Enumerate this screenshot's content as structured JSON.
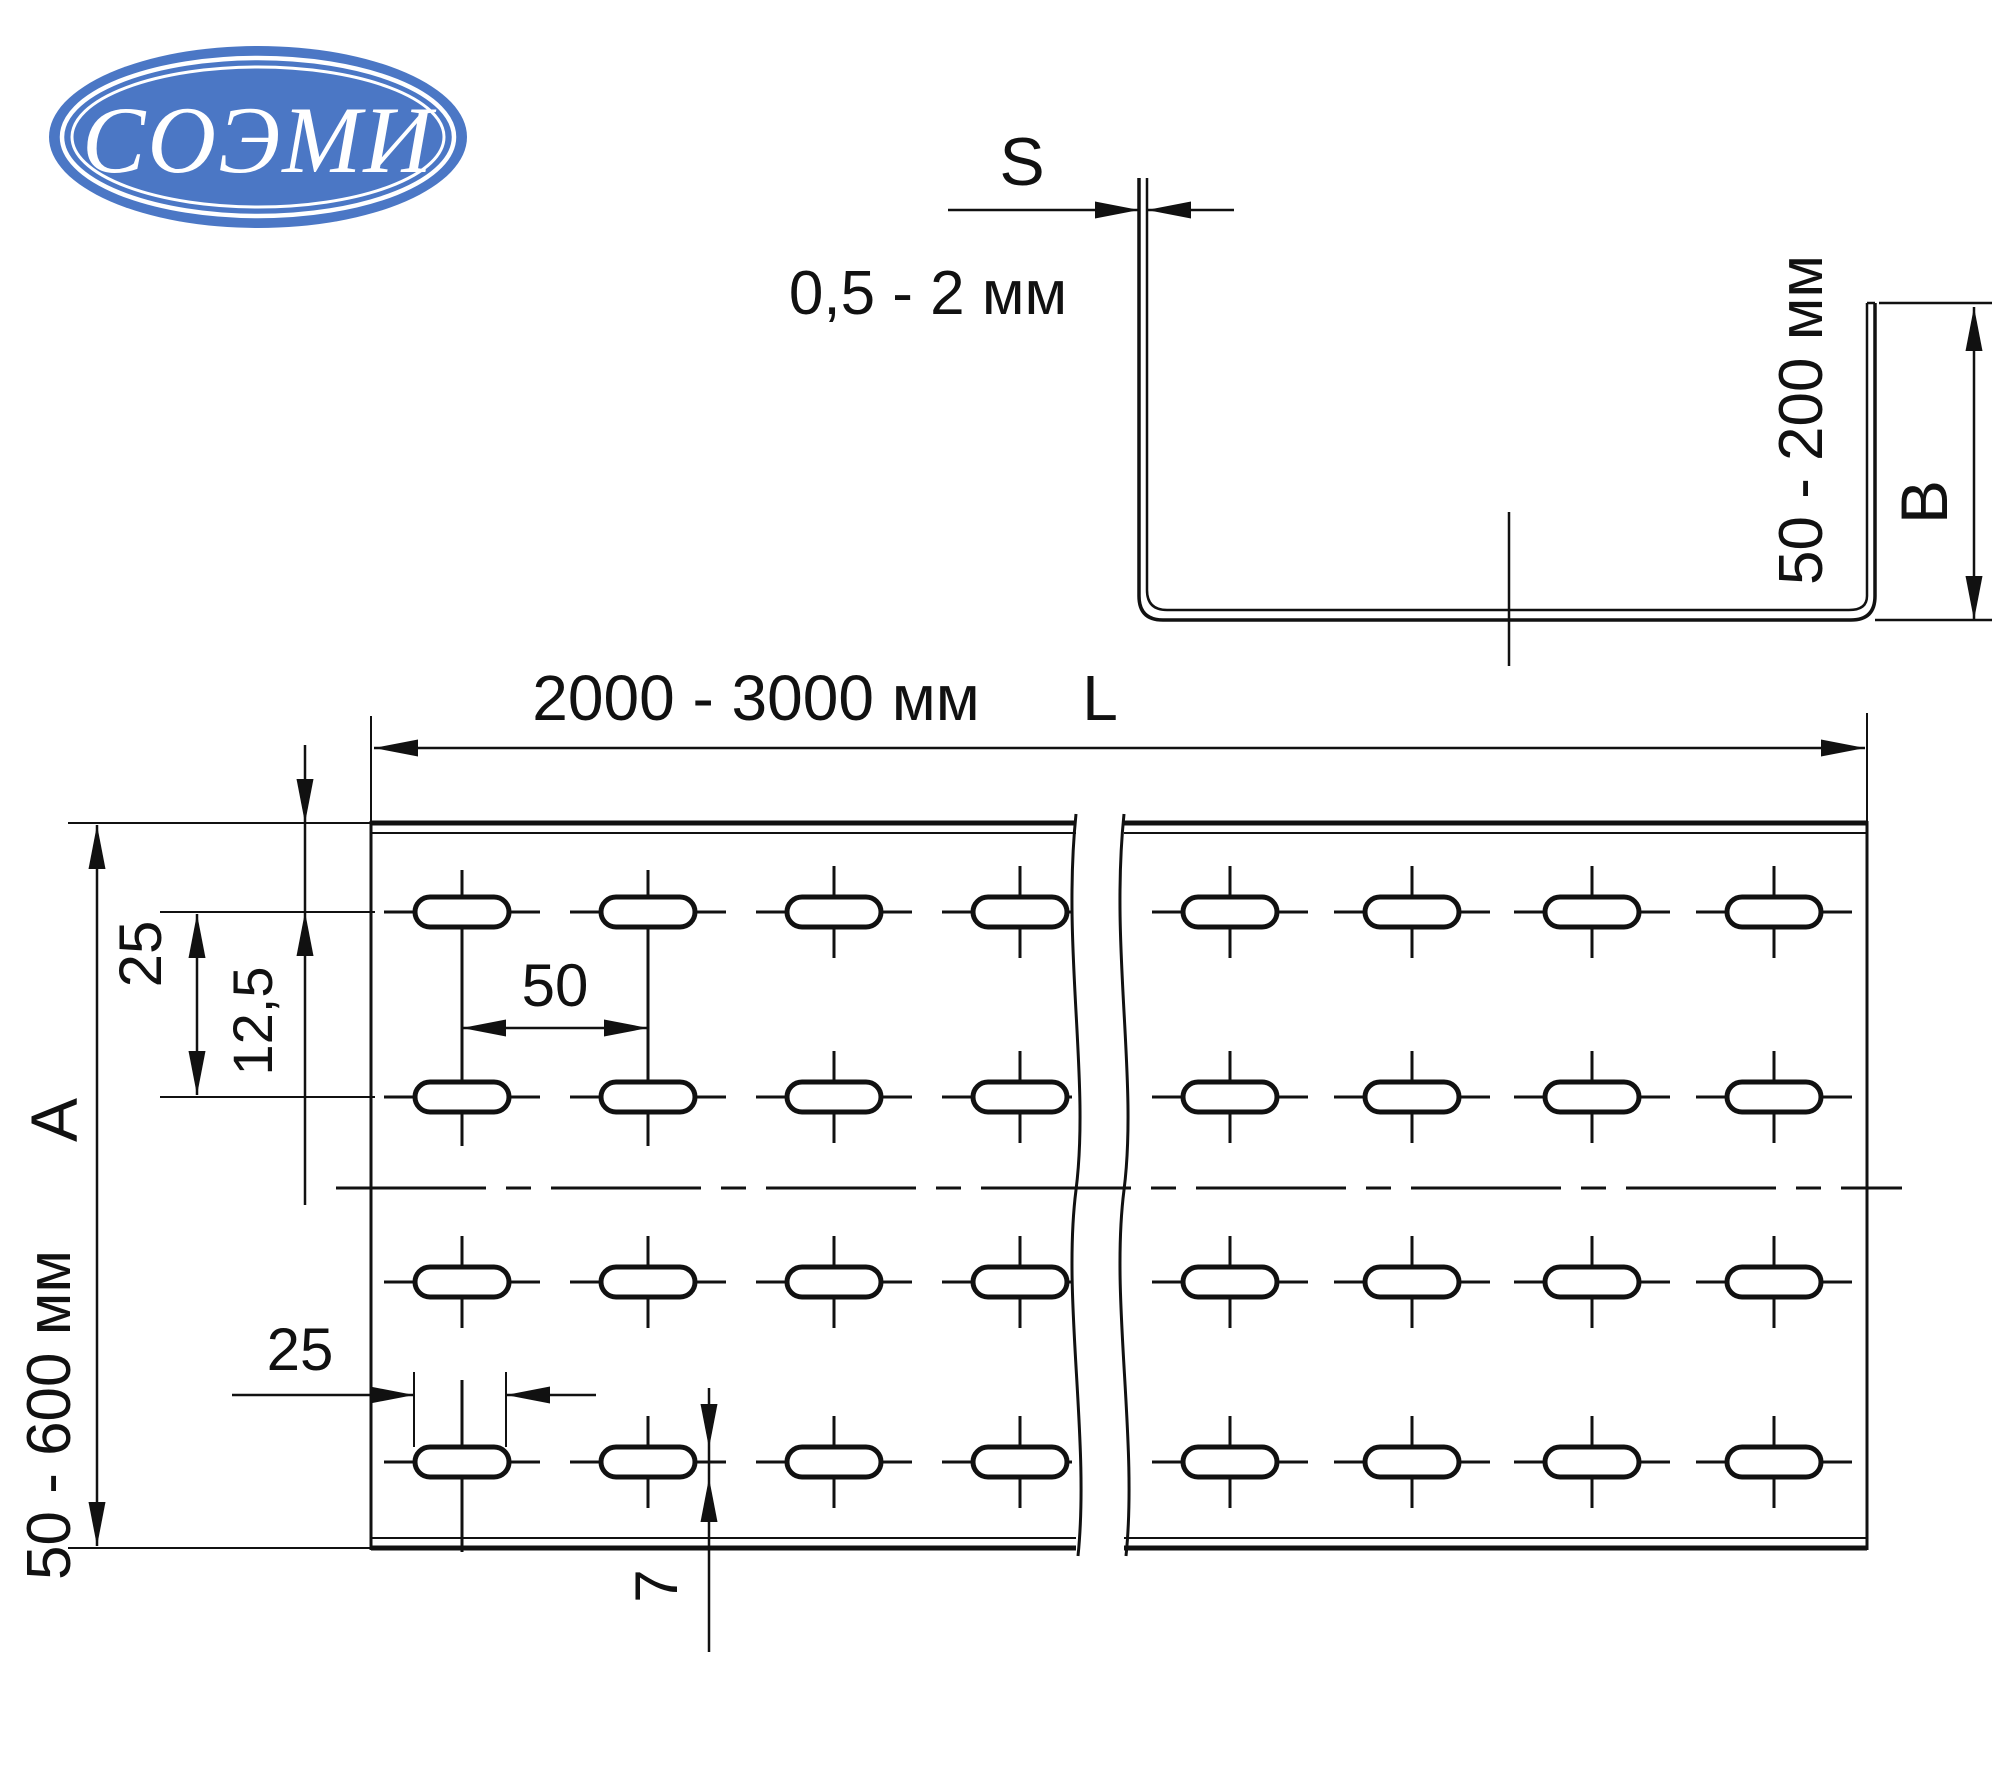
{
  "colors": {
    "line": "#111111",
    "logo_blue": "#4b77c5",
    "logo_ring": "#ffffff",
    "background": "#ffffff"
  },
  "logo": {
    "text": "СОЭМИ"
  },
  "cross_section": {
    "thickness_letter": "S",
    "thickness_range": "0,5 - 2 мм",
    "height_range": "50 - 200 мм",
    "height_letter": "B"
  },
  "plan_view": {
    "length_range": "2000 - 3000 мм",
    "length_letter": "L",
    "width_range": "50 - 600 мм",
    "width_letter": "A",
    "hole_pitch_x": "50",
    "hole_pitch_y": "25",
    "edge_offset": "12,5",
    "slot_length": "25",
    "slot_width": "7"
  }
}
